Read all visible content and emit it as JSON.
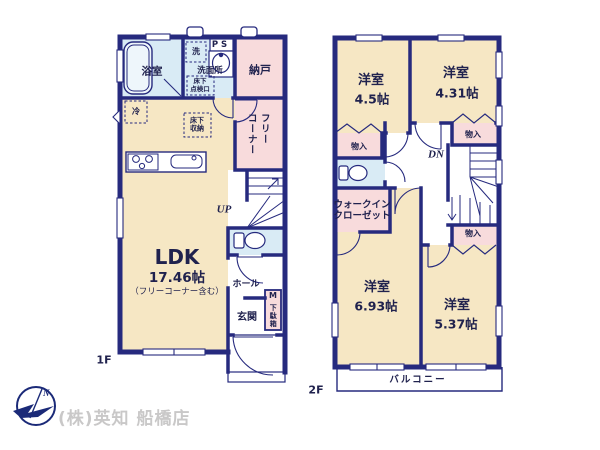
{
  "floor1": {
    "label": "1F",
    "rooms": {
      "bath": "浴室",
      "washer": "洗",
      "ps": "PS",
      "washroom": "洗面所",
      "underfloor_access": "床下\n点検口",
      "storeroom": "納戸",
      "fridge": "冷",
      "underfloor_storage": "床下\n収納",
      "free_corner_a": "フリー",
      "free_corner_b": "コーナー",
      "stairs_up": "UP",
      "ldk": "LDK",
      "ldk_size": "17.46帖",
      "ldk_note": "（フリーコーナー含む）",
      "hall": "ホール",
      "shoe_m": "M",
      "shoe_box": "下駄箱",
      "entrance": "玄関"
    }
  },
  "floor2": {
    "label": "2F",
    "rooms": {
      "room_a": "洋室",
      "room_a_size": "4.5帖",
      "room_b": "洋室",
      "room_b_size": "4.31帖",
      "closet_a": "物入",
      "closet_b": "物入",
      "closet_c": "物入",
      "stairs_down": "DN",
      "wic": "ウォークイン\nクローゼット",
      "room_c": "洋室",
      "room_c_size": "6.93帖",
      "room_d": "洋室",
      "room_d_size": "5.37帖",
      "balcony": "バルコニー"
    }
  },
  "footer": {
    "company": "(株)英知 船橋店"
  },
  "colors": {
    "wall": "#262a7e",
    "cream": "#f6e7c4",
    "pink": "#f8dbdc",
    "blue": "#d9ebf5",
    "text": "#20224e",
    "footer": "#c9c8c8",
    "logo": "#1b2a78"
  }
}
